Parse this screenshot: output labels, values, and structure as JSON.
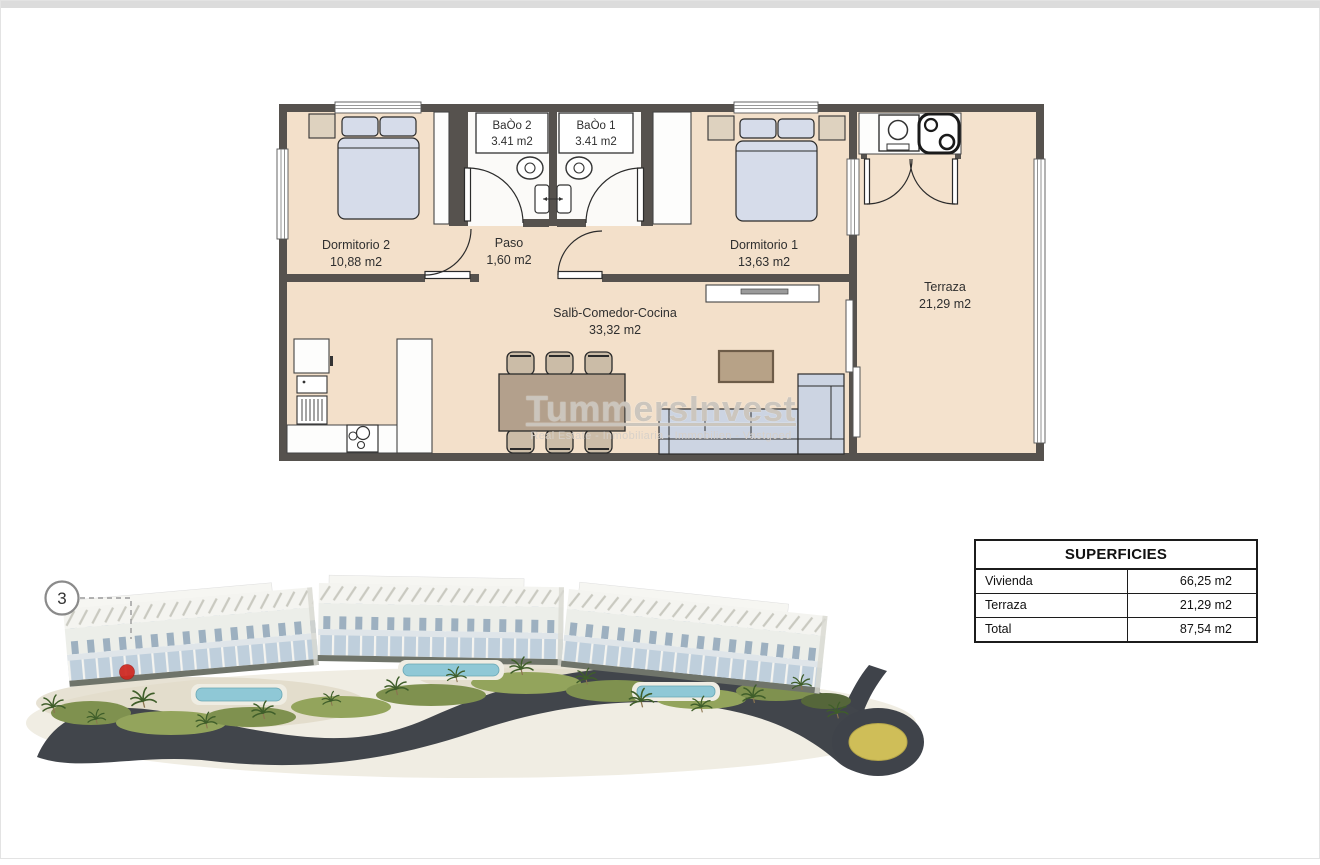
{
  "floor_plan": {
    "rooms": {
      "bano2": {
        "name": "BaÒo 2",
        "area": "3.41 m2"
      },
      "bano1": {
        "name": "BaÒo 1",
        "area": "3.41 m2"
      },
      "dormitorio2": {
        "name": "Dormitorio 2",
        "area": "10,88 m2"
      },
      "paso": {
        "name": "Paso",
        "area": "1,60 m2"
      },
      "dormitorio1": {
        "name": "Dormitorio 1",
        "area": "13,63 m2"
      },
      "salon": {
        "name": "Salḃ-Comedor-Cocina",
        "area": "33,32 m2"
      },
      "terraza": {
        "name": "Terraza",
        "area": "21,29 m2"
      }
    },
    "colors": {
      "wall": "#56524e",
      "floor": "#f3e0ca",
      "upholstery": "#d4dae8",
      "wood": "#b3a08c",
      "unit_marker_red": "#d0271f"
    }
  },
  "watermark": {
    "title": "TummersInvest",
    "subtitle": "Real Estate - Inmobiliaria - Immobilien - Vastgoed"
  },
  "site_plan": {
    "unit_marker": "3"
  },
  "superficies_table": {
    "title": "SUPERFICIES",
    "rows": [
      {
        "label": "Vivienda",
        "value": "66,25 m2"
      },
      {
        "label": "Terraza",
        "value": "21,29 m2"
      },
      {
        "label": "Total",
        "value": "87,54 m2"
      }
    ]
  }
}
